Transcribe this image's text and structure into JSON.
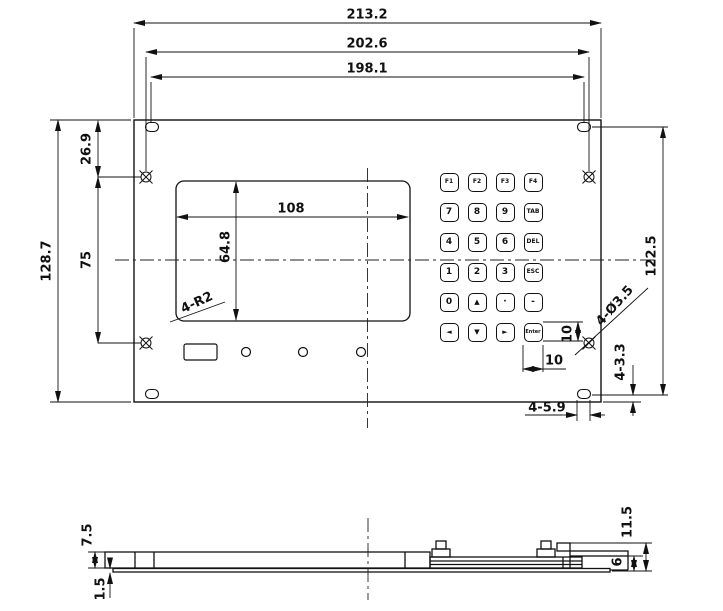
{
  "front_view": {
    "dims": {
      "overall_width": "213.2",
      "hole_span_h": "202.6",
      "slot_span_h": "198.1",
      "overall_height": "128.7",
      "edge_to_hole": "26.9",
      "hole_spacing_v": "75",
      "slot_span_v": "122.5",
      "window_width": "108",
      "window_height": "64.8",
      "window_corner_radius": "4-R2",
      "hole_callout": "4-Ø3.5",
      "slot_edge_offset": "4-3.3",
      "slot_width": "4-5.9",
      "key_height": "10",
      "key_width": "10"
    },
    "keypad": {
      "rows": [
        [
          "F1",
          "F2",
          "F3",
          "F4"
        ],
        [
          "7",
          "8",
          "9",
          "TAB"
        ],
        [
          "4",
          "5",
          "6",
          "DEL"
        ],
        [
          "1",
          "2",
          "3",
          "ESC"
        ],
        [
          "0",
          "▲",
          "·",
          "-"
        ],
        [
          "◄",
          "▼",
          "►",
          "Enter"
        ]
      ]
    }
  },
  "side_view": {
    "dims": {
      "panel_thickness": "7.5",
      "base_thickness": "1.5",
      "total_height": "11.5",
      "stack_height": "6"
    }
  }
}
